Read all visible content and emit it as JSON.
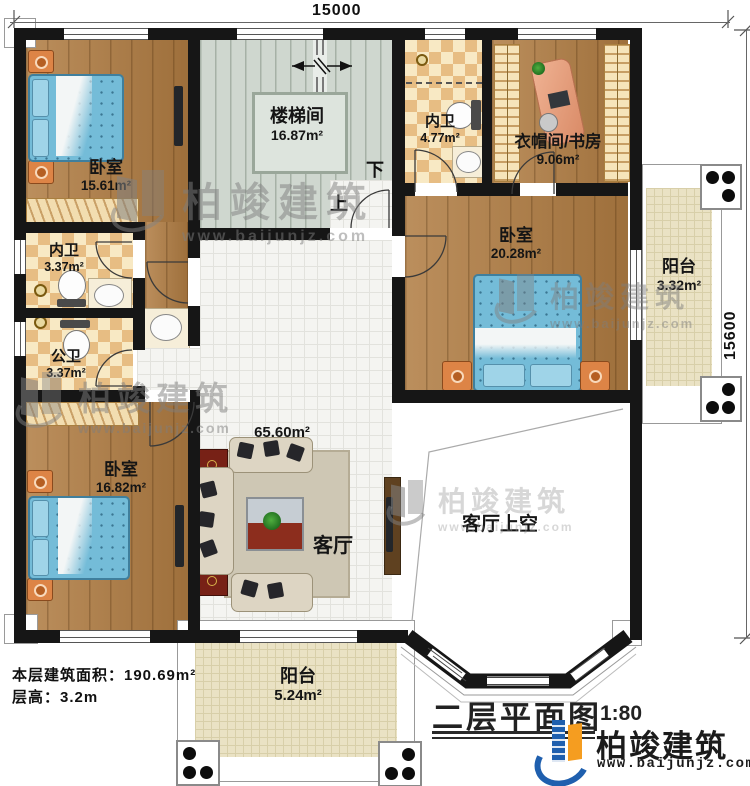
{
  "plan": {
    "title": "二层平面图",
    "scale": "1:80",
    "dim_top": "15000",
    "dim_right": "15600",
    "stair_down": "下",
    "stair_up": "上",
    "footer_area": "本层建筑面积：190.69m²",
    "footer_height": "层高：3.2m"
  },
  "rooms": [
    {
      "id": "bedroom-top-left",
      "label": "卧室",
      "area": "15.61m²"
    },
    {
      "id": "stairwell",
      "label": "楼梯间",
      "area": "16.87m²"
    },
    {
      "id": "ensuite-bath-north",
      "label": "内卫",
      "area": "4.77m²"
    },
    {
      "id": "closet-study",
      "label": "衣帽间/书房",
      "area": "9.06m²"
    },
    {
      "id": "bedroom-east",
      "label": "卧室",
      "area": "20.28m²"
    },
    {
      "id": "balcony-east",
      "label": "阳台",
      "area": "3.32m²"
    },
    {
      "id": "ensuite-bath-west",
      "label": "内卫",
      "area": "3.37m²"
    },
    {
      "id": "shared-bath",
      "label": "公卫",
      "area": "3.37m²"
    },
    {
      "id": "bedroom-southwest",
      "label": "卧室",
      "area": "16.82m²"
    },
    {
      "id": "living-room",
      "label": "客厅",
      "area": "65.60m²"
    },
    {
      "id": "living-void",
      "label": "客厅上空",
      "area": ""
    },
    {
      "id": "balcony-south",
      "label": "阳台",
      "area": "5.24m²"
    }
  ],
  "brand": {
    "name": "柏竣建筑",
    "url": "www.baijunjz.com"
  },
  "watermark": {
    "text": "柏竣建筑",
    "url": "www.baijunjz.com"
  }
}
